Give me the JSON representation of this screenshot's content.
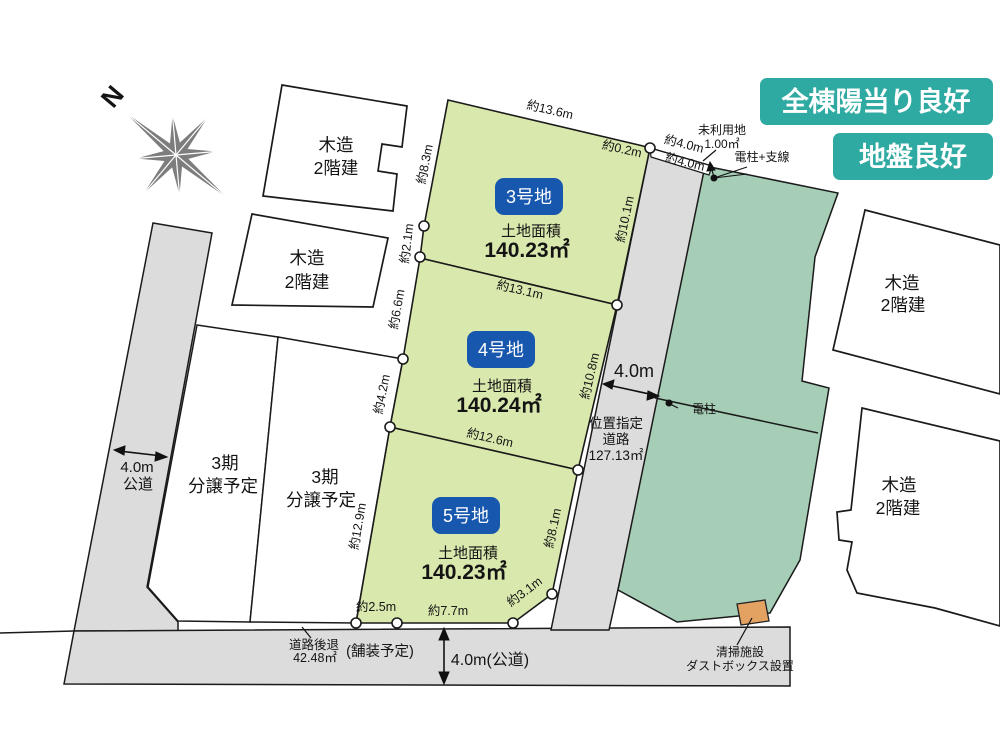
{
  "colors": {
    "lot_green": "#d9e8ad",
    "neighbor_teal": "#a6cdb6",
    "road_gray": "#dcdcdc",
    "promo_badge_teal": "#2faaa2",
    "lot_badge_blue": "#1757ae",
    "dustbox_orange": "#e4a262",
    "compass_gray": "#7d7d7d"
  },
  "promo": {
    "sunlight": "全棟陽当り良好",
    "ground": "地盤良好"
  },
  "compass": {
    "north": "N"
  },
  "lots": [
    {
      "name": "3号地",
      "area_label": "土地面積",
      "area": "140.23㎡"
    },
    {
      "name": "4号地",
      "area_label": "土地面積",
      "area": "140.24㎡"
    },
    {
      "name": "5号地",
      "area_label": "土地面積",
      "area": "140.23㎡"
    }
  ],
  "dims": {
    "top": "約13.6m",
    "left1": "約8.3m",
    "left2": "約2.1m",
    "left3": "約6.6m",
    "left4": "約4.2m",
    "left5": "約12.9m",
    "div34": "約13.1m",
    "div45": "約12.6m",
    "right3": "約10.1m",
    "right4": "約10.8m",
    "right5": "約8.1m",
    "corner": "約3.1m",
    "bottom1": "約2.5m",
    "bottom2": "約7.7m",
    "tiny": "約0.2m",
    "road_top_a": "約4.0m",
    "road_top_b": "約4.0m"
  },
  "road_mid": {
    "width": "4.0m",
    "label1": "位置指定",
    "label2": "道路",
    "label3": "127.13㎡"
  },
  "road_left": {
    "width": "4.0m",
    "type": "公道"
  },
  "road_bottom": {
    "width": "4.0m(公道)",
    "setback1": "道路後退",
    "setback2": "42.48㎡",
    "paving": "(舗装予定)"
  },
  "unused_land": {
    "line1": "未利用地",
    "line2": "1.00㎡"
  },
  "pole_top": "電柱+支線",
  "pole_mid": "電柱",
  "phase3": {
    "line1": "3期",
    "line2": "分譲予定"
  },
  "building": {
    "line1": "木造",
    "line2": "2階建"
  },
  "dustbox": {
    "line1": "清掃施設",
    "line2": "ダストボックス設置"
  }
}
